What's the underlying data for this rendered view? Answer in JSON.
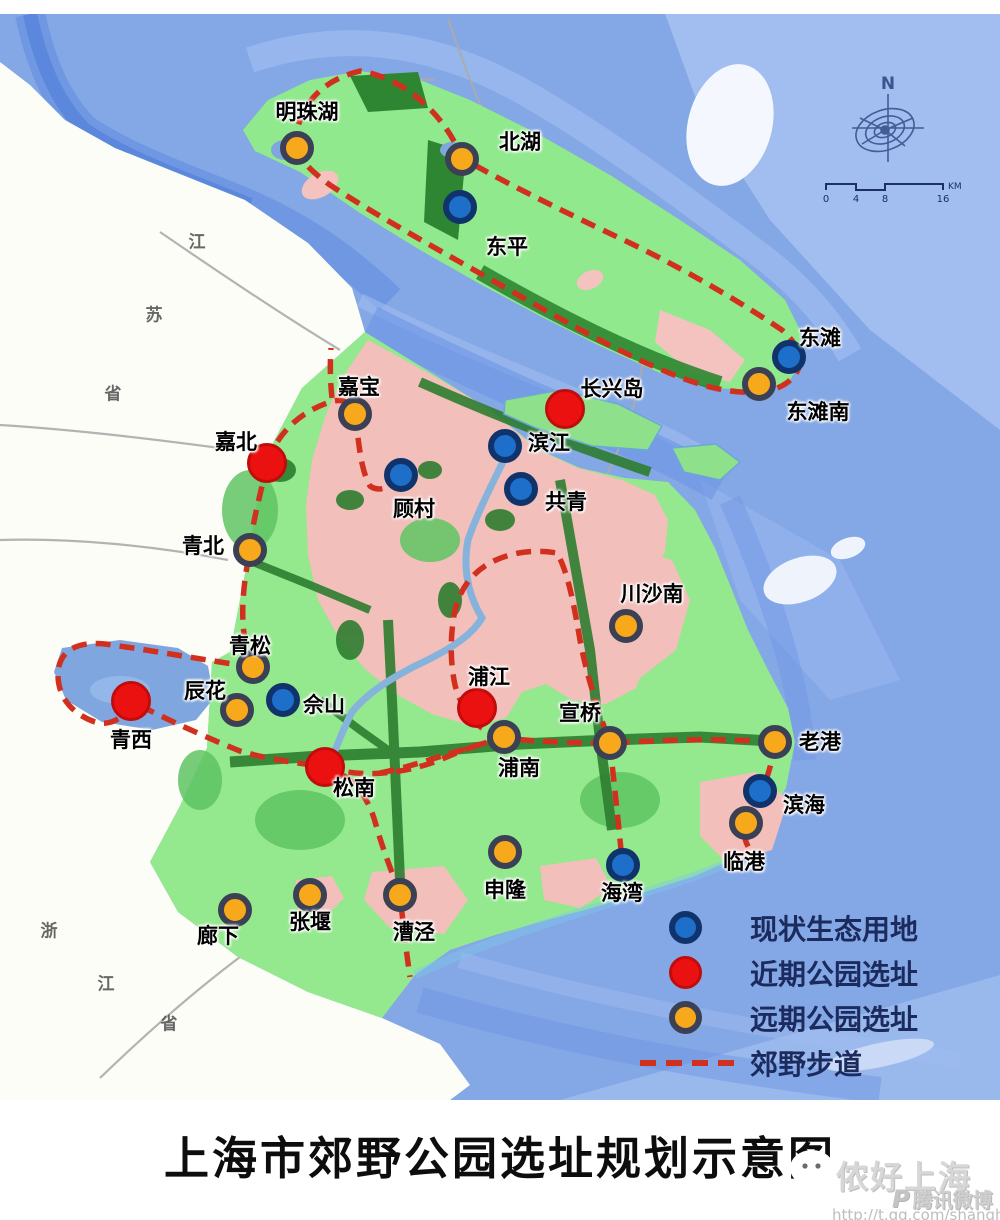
{
  "title": "上海市郊野公园选址规划示意图",
  "compass": {
    "label": "N"
  },
  "scale_bar": {
    "ticks": [
      "0",
      "4",
      "8",
      "16"
    ],
    "unit": "KM"
  },
  "trail": {
    "label": "郊野步道",
    "color": "#d2301f"
  },
  "site_types": {
    "existing": {
      "label": "现状生态用地",
      "fill": "#1d6fc9",
      "ring": "#10336b"
    },
    "near_term": {
      "label": "近期公园选址",
      "fill": "#ec1111",
      "ring": "#c20c0c"
    },
    "long_term": {
      "label": "远期公园选址",
      "fill": "#f7a81b",
      "ring": "#3c4055"
    }
  },
  "sites": [
    {
      "name": "明珠湖",
      "type": "long_term",
      "cx": 297,
      "cy": 148,
      "lx": 307,
      "ly": 111
    },
    {
      "name": "北湖",
      "type": "long_term",
      "cx": 462,
      "cy": 159,
      "lx": 520,
      "ly": 141
    },
    {
      "name": "东平",
      "type": "existing",
      "cx": 460,
      "cy": 207,
      "lx": 507,
      "ly": 246
    },
    {
      "name": "东滩",
      "type": "existing",
      "cx": 789,
      "cy": 357,
      "lx": 820,
      "ly": 337
    },
    {
      "name": "东滩南",
      "type": "long_term",
      "cx": 759,
      "cy": 384,
      "lx": 818,
      "ly": 411
    },
    {
      "name": "嘉宝",
      "type": "long_term",
      "cx": 355,
      "cy": 414,
      "lx": 359,
      "ly": 386
    },
    {
      "name": "嘉北",
      "type": "near_term",
      "cx": 267,
      "cy": 463,
      "lx": 236,
      "ly": 441
    },
    {
      "name": "长兴岛",
      "type": "near_term",
      "cx": 565,
      "cy": 409,
      "lx": 612,
      "ly": 388
    },
    {
      "name": "滨江",
      "type": "existing",
      "cx": 505,
      "cy": 446,
      "lx": 549,
      "ly": 442
    },
    {
      "name": "顾村",
      "type": "existing",
      "cx": 401,
      "cy": 475,
      "lx": 414,
      "ly": 508
    },
    {
      "name": "共青",
      "type": "existing",
      "cx": 521,
      "cy": 489,
      "lx": 566,
      "ly": 501
    },
    {
      "name": "青北",
      "type": "long_term",
      "cx": 250,
      "cy": 550,
      "lx": 203,
      "ly": 545
    },
    {
      "name": "川沙南",
      "type": "long_term",
      "cx": 626,
      "cy": 626,
      "lx": 652,
      "ly": 593
    },
    {
      "name": "青松",
      "type": "long_term",
      "cx": 253,
      "cy": 667,
      "lx": 250,
      "ly": 645
    },
    {
      "name": "辰花",
      "type": "long_term",
      "cx": 237,
      "cy": 710,
      "lx": 205,
      "ly": 690
    },
    {
      "name": "佘山",
      "type": "existing",
      "cx": 283,
      "cy": 700,
      "lx": 324,
      "ly": 704
    },
    {
      "name": "浦江",
      "type": "near_term",
      "cx": 477,
      "cy": 708,
      "lx": 489,
      "ly": 676
    },
    {
      "name": "宣桥",
      "type": "long_term",
      "cx": 610,
      "cy": 743,
      "lx": 580,
      "ly": 712
    },
    {
      "name": "青西",
      "type": "near_term",
      "cx": 131,
      "cy": 701,
      "lx": 131,
      "ly": 739
    },
    {
      "name": "老港",
      "type": "long_term",
      "cx": 775,
      "cy": 742,
      "lx": 820,
      "ly": 741
    },
    {
      "name": "松南",
      "type": "near_term",
      "cx": 325,
      "cy": 767,
      "lx": 354,
      "ly": 787
    },
    {
      "name": "浦南",
      "type": "long_term",
      "cx": 504,
      "cy": 737,
      "lx": 519,
      "ly": 767
    },
    {
      "name": "滨海",
      "type": "existing",
      "cx": 760,
      "cy": 791,
      "lx": 804,
      "ly": 804
    },
    {
      "name": "临港",
      "type": "long_term",
      "cx": 746,
      "cy": 823,
      "lx": 744,
      "ly": 861
    },
    {
      "name": "申隆",
      "type": "long_term",
      "cx": 505,
      "cy": 852,
      "lx": 505,
      "ly": 889
    },
    {
      "name": "海湾",
      "type": "existing",
      "cx": 623,
      "cy": 865,
      "lx": 622,
      "ly": 892
    },
    {
      "name": "廊下",
      "type": "long_term",
      "cx": 235,
      "cy": 910,
      "lx": 218,
      "ly": 935
    },
    {
      "name": "张堰",
      "type": "long_term",
      "cx": 310,
      "cy": 895,
      "lx": 310,
      "ly": 921
    },
    {
      "name": "漕泾",
      "type": "long_term",
      "cx": 400,
      "cy": 895,
      "lx": 414,
      "ly": 931
    }
  ],
  "provinces": [
    {
      "name": "江苏省",
      "chars": [
        {
          "t": "江",
          "x": 197,
          "y": 240
        },
        {
          "t": "苏",
          "x": 154,
          "y": 313
        },
        {
          "t": "省",
          "x": 113,
          "y": 392
        }
      ]
    },
    {
      "name": "浙江省",
      "chars": [
        {
          "t": "浙",
          "x": 49,
          "y": 929
        },
        {
          "t": "江",
          "x": 106,
          "y": 982
        },
        {
          "t": "省",
          "x": 169,
          "y": 1022
        }
      ]
    }
  ],
  "watermark": {
    "name": "侬好上海",
    "platform_logo": "P",
    "platform": "腾讯微博",
    "url": "http://t.qq.com/shanghaicity"
  }
}
